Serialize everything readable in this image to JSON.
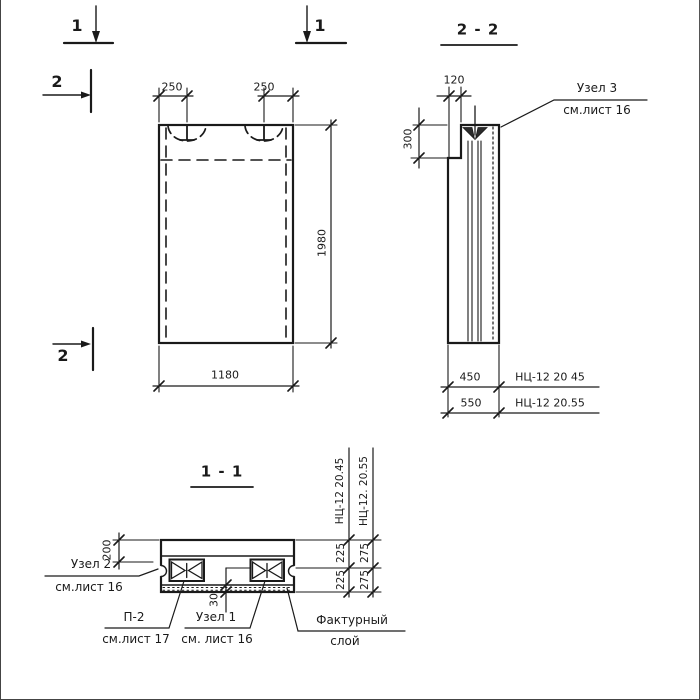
{
  "colors": {
    "ink": "#1a1a1a",
    "paper": "#ffffff"
  },
  "markers": {
    "s1_left": "1",
    "s1_right": "1",
    "s2_top": "2",
    "s2_bottom": "2"
  },
  "titles": {
    "section_2_2": "2 - 2",
    "section_1_1": "1 - 1"
  },
  "front_view": {
    "dim_loop_left": "250",
    "dim_loop_right": "250",
    "dim_height": "1980",
    "dim_width": "1180"
  },
  "side_view": {
    "dim_top": "120",
    "dim_notch": "300",
    "dim_thick_1": "450",
    "dim_thick_2": "550",
    "mark_1": "НЦ-12 20 45",
    "mark_2": "НЦ-12 20.55",
    "node3": "Узел 3",
    "node3_ref": "см.лист 16"
  },
  "section_1_1": {
    "dim_edge": "200",
    "dim_layer": "30",
    "dim_half_1a": "225",
    "dim_half_1b": "225",
    "dim_half_2a": "275",
    "dim_half_2b": "275",
    "mark_1": "НЦ-12 20.45",
    "mark_2": "НЦ-12. 20.55",
    "node2": "Узел 2",
    "node2_ref": "см.лист 16",
    "p2": "П-2",
    "p2_ref": "см.лист 17",
    "node1": "Узел 1",
    "node1_ref": "см. лист 16",
    "finish_layer_1": "Фактурный",
    "finish_layer_2": "слой"
  }
}
